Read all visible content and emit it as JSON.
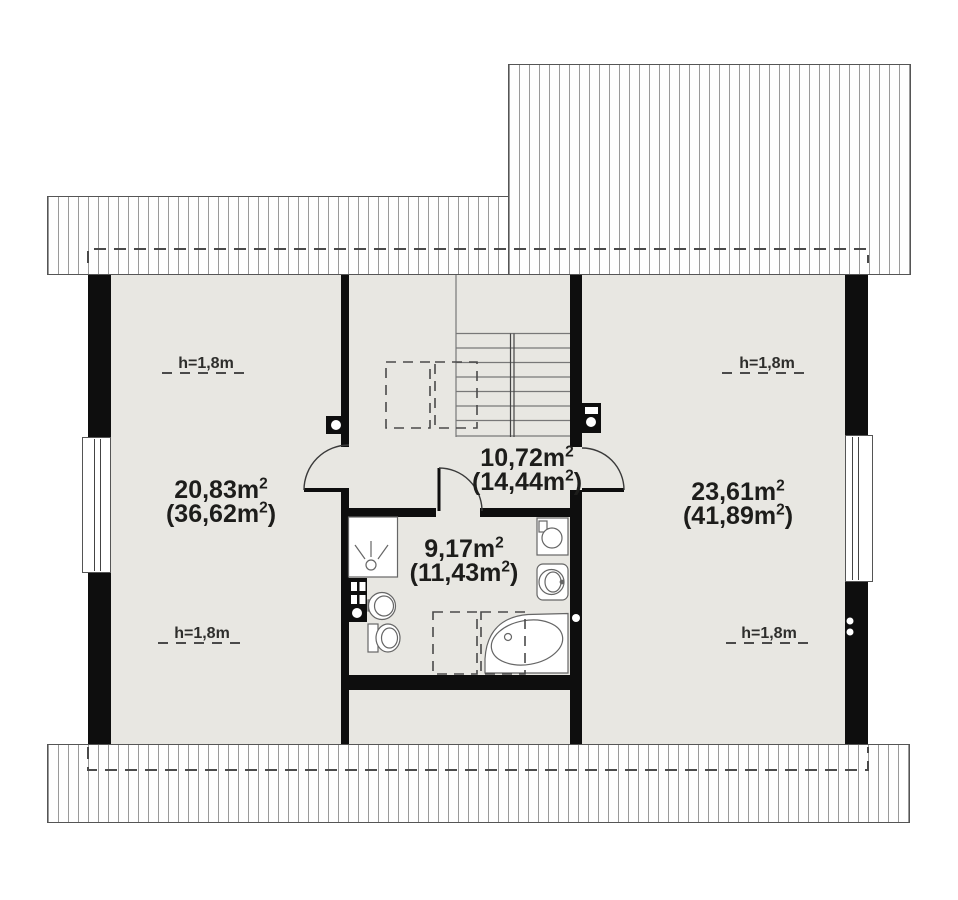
{
  "plan_type": "attic-floor-plan",
  "rooms": [
    {
      "name": "room-left",
      "area": "20,83m²",
      "floor_area": "(36,62m²)"
    },
    {
      "name": "hall-stairs",
      "area": "10,72m²",
      "floor_area": "(14,44m²)"
    },
    {
      "name": "bathroom",
      "area": "9,17m²",
      "floor_area": "(11,43m²)"
    },
    {
      "name": "room-right",
      "area": "23,61m²",
      "floor_area": "(41,89m²)"
    }
  ],
  "height_label": "h=1,8m",
  "colors": {
    "wall": "#0e0e0e",
    "floor": "#e8e7e2",
    "hatch_line": "#9a9a9a",
    "dash_line": "#4a4a4a",
    "text": "#1d1d1b",
    "fixture_stroke": "#666666"
  }
}
